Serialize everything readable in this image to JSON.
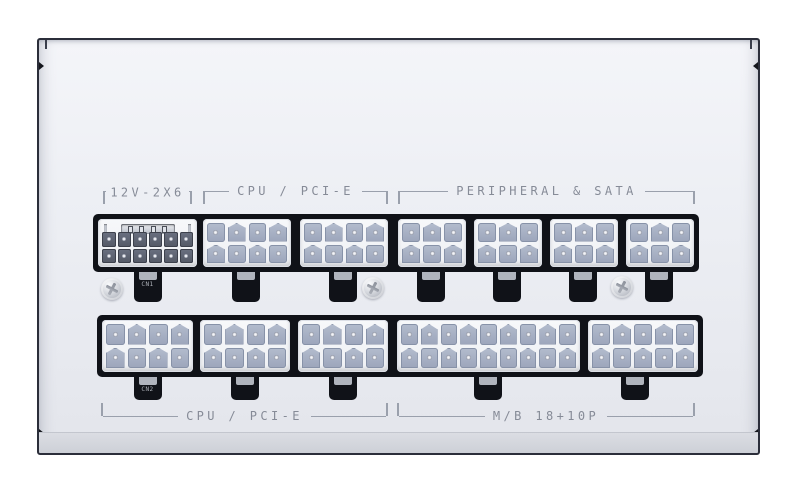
{
  "section_labels": {
    "top_left": "12V-2X6",
    "top_cpu": "CPU / PCI-E",
    "top_peripheral": "PERIPHERAL & SATA",
    "bottom_cpu": "CPU / PCI-E",
    "bottom_mb": "M/B 18+10P"
  },
  "connector_rows": {
    "top": [
      {
        "name": "connector-12v-2x6",
        "type": "hp",
        "cols": 6,
        "rows": 2,
        "sense_pins": 4,
        "tab_label": "CN1"
      },
      {
        "name": "connector-cpu-pcie-8pin-1",
        "type": "mf",
        "cols": 4,
        "rows": 2,
        "tab_label": ""
      },
      {
        "name": "connector-cpu-pcie-8pin-2",
        "type": "mf",
        "cols": 4,
        "rows": 2,
        "tab_label": ""
      },
      {
        "name": "connector-peripheral-6pin-1",
        "type": "mf",
        "cols": 3,
        "rows": 2,
        "tab_label": ""
      },
      {
        "name": "connector-peripheral-6pin-2",
        "type": "mf",
        "cols": 3,
        "rows": 2,
        "tab_label": ""
      },
      {
        "name": "connector-peripheral-6pin-3",
        "type": "mf",
        "cols": 3,
        "rows": 2,
        "tab_label": ""
      },
      {
        "name": "connector-peripheral-6pin-4",
        "type": "mf",
        "cols": 3,
        "rows": 2,
        "tab_label": ""
      }
    ],
    "bottom": [
      {
        "name": "connector-cpu-pcie-8pin-3",
        "type": "mf",
        "cols": 4,
        "rows": 2,
        "tab_label": "CN2"
      },
      {
        "name": "connector-cpu-pcie-8pin-4",
        "type": "mf",
        "cols": 4,
        "rows": 2,
        "tab_label": ""
      },
      {
        "name": "connector-cpu-pcie-8pin-5",
        "type": "mf",
        "cols": 4,
        "rows": 2,
        "tab_label": ""
      },
      {
        "name": "connector-mb-18pin",
        "type": "mf",
        "cols": 9,
        "rows": 2,
        "tab_label": ""
      },
      {
        "name": "connector-mb-10pin",
        "type": "mf",
        "cols": 5,
        "rows": 2,
        "tab_label": ""
      }
    ]
  },
  "colors": {
    "panel_face": "#eceef3",
    "panel_outline": "#2b2e3a",
    "recess_black": "#101218",
    "pin_light": "#a8b1c5",
    "pin_dark": "#5d6270",
    "label_gray": "#8a8f9a",
    "screw_silver": "#c9ccd3"
  }
}
